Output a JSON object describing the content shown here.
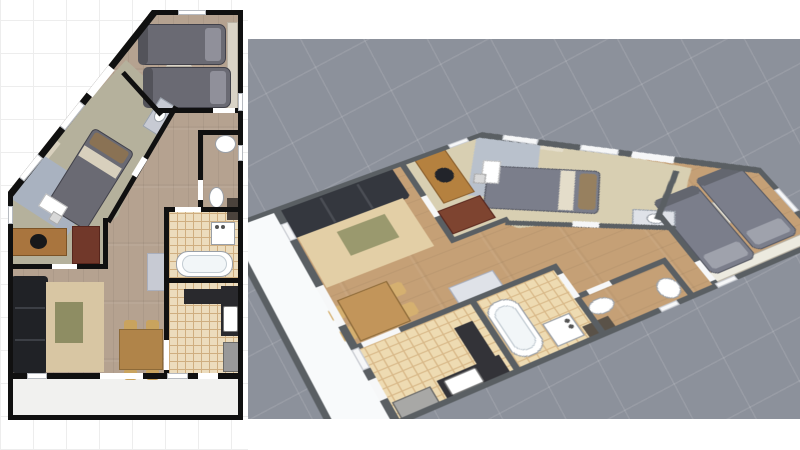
{
  "meta": {
    "description": "Apartment floor plan shown twice: 2D top-down plan (left) and 3D aerial perspective render (right)",
    "left_view": "2D floor plan",
    "right_view": "3D perspective render",
    "visible_text": "none"
  },
  "layout": {
    "width": 800,
    "height": 450,
    "left_canvas": {
      "x": 0,
      "y": 0,
      "w": 248,
      "h": 450,
      "bg": "#ffffff",
      "grid_color": "#ededed",
      "grid_step": 33
    },
    "right_canvas": {
      "x": 248,
      "y": 39,
      "w": 552,
      "h": 380,
      "bg": "#8c919b",
      "grid_color": "rgba(255,255,255,0.10)",
      "grid_step": 56,
      "grid_angle_deg": 62
    },
    "plan2d_offset": {
      "x": 8,
      "y": 10
    },
    "plan3d_position": {
      "x": 158,
      "y": -10
    },
    "plan3d_transform": "perspective(1400px) rotateX(42deg) rotateZ(62deg) scale(1.28)"
  },
  "themes": {
    "plan2d": {
      "wall": "#101010",
      "opening": "#ffffff",
      "wood": "#b5a290",
      "olive": "#b5b19c",
      "tile": "#ecdcbd",
      "tileLine": "#cfae80",
      "balcony": "#f1f1ef",
      "closet": "#d9d3c6",
      "bed": "#6a6a73",
      "bedDark": "#53535a",
      "bedBorder": "#41414a",
      "pillowGray": "#90909a",
      "pillowBrown": "#8a7254",
      "linen": "#d8d0bd",
      "rugBlue": "#a9b2c0",
      "rugBeige": "#d8c6a3",
      "tableOlive": "#8e8d63",
      "sofa": "#202226",
      "sofaLine": "#3c3f45",
      "deskWood": "#a9753e",
      "deskEdge": "#7c5326",
      "cabinetRed": "#71382a",
      "dining": "#b08449",
      "chair": "#c9a35e",
      "counter": "#29292d",
      "appliance": "#99999a",
      "hallCab": "#c7cad3",
      "white": "#ffffff",
      "fixture": "#9aa0a8",
      "tallCab": "#4a423c",
      "chairBlack": "#17181a",
      "winEdge": "#b6bac0"
    },
    "plan3d": {
      "wall": "#5a5f63",
      "opening": "#f6f7f8",
      "wood": "#c5a076",
      "olive": "#d8cfb2",
      "tile": "#eedbb2",
      "tileLine": "#d8b888",
      "balcony": "#f8fafb",
      "closet": "#eceadf",
      "bed": "#7b7e8b",
      "bedDark": "#63666f",
      "bedBorder": "#565964",
      "pillowGray": "#9fa2ac",
      "pillowBrown": "#97805f",
      "linen": "#e4ddca",
      "rugBlue": "#b9c1cc",
      "rugBeige": "#e3cfa6",
      "tableOlive": "#9a996e",
      "sofa": "#34373e",
      "sofaLine": "#4a4d54",
      "deskWood": "#b5813f",
      "deskEdge": "#8a5e2c",
      "cabinetRed": "#7e4430",
      "dining": "#c2955a",
      "chair": "#d5b070",
      "counter": "#333338",
      "appliance": "#a8a8a6",
      "hallCab": "#dfe2e8",
      "white": "#ffffff",
      "fixture": "#9aa0a8",
      "tallCab": "#5a5248",
      "chairBlack": "#22242a",
      "winEdge": "#c9ccd2"
    }
  },
  "plan": {
    "w": 235,
    "h": 410,
    "outline": [
      [
        144,
        0
      ],
      [
        235,
        0
      ],
      [
        235,
        410
      ],
      [
        0,
        410
      ],
      [
        0,
        182
      ]
    ],
    "floors": [
      {
        "n": "floor-wood-base",
        "t": "rect",
        "x": 0,
        "y": 0,
        "w": 235,
        "h": 410,
        "f": "wood",
        "pat": "wood"
      },
      {
        "n": "floor-bedroom-office-olive",
        "t": "poly",
        "x": 0,
        "y": 0,
        "w": 235,
        "h": 410,
        "f": "olive",
        "pts": [
          [
            118,
            50
          ],
          [
            170,
            98
          ],
          [
            122,
            172
          ],
          [
            110,
            206
          ],
          [
            97,
            214
          ],
          [
            97,
            258
          ],
          [
            0,
            258
          ],
          [
            0,
            180
          ]
        ]
      },
      {
        "n": "floor-bathroom-tile",
        "t": "rect",
        "x": 161,
        "y": 202,
        "w": 71,
        "h": 66,
        "f": "tile",
        "pat": "tile"
      },
      {
        "n": "floor-kitchen-tile",
        "t": "rect",
        "x": 161,
        "y": 273,
        "w": 71,
        "h": 95,
        "f": "tile",
        "pat": "tile"
      },
      {
        "n": "floor-balcony",
        "t": "rect",
        "x": 5,
        "y": 369,
        "w": 225,
        "h": 36,
        "f": "balcony"
      }
    ],
    "furniture": [
      {
        "n": "twin-room-wardrobe",
        "t": "rect",
        "x": 219,
        "y": 12,
        "w": 11,
        "h": 88,
        "f": "closet",
        "bd": "#b9b2a4"
      },
      {
        "n": "twin-room-nightstand",
        "t": "rect",
        "x": 158,
        "y": 46,
        "w": 26,
        "h": 11,
        "f": "closet",
        "bd": "#b9b2a4"
      },
      {
        "n": "twin-bed-1",
        "t": "rect",
        "x": 130,
        "y": 14,
        "w": 88,
        "h": 41,
        "f": "bed",
        "bd": "bedBorder",
        "rad": 7
      },
      {
        "n": "twin-bed-1-foot",
        "t": "rect",
        "x": 130,
        "y": 14,
        "w": 10,
        "h": 41,
        "f": "bedDark",
        "rad": 7
      },
      {
        "n": "twin-bed-1-pillow",
        "t": "rect",
        "x": 197,
        "y": 18,
        "w": 16,
        "h": 33,
        "f": "pillowGray",
        "rad": 3
      },
      {
        "n": "twin-bed-2",
        "t": "rect",
        "x": 135,
        "y": 57,
        "w": 88,
        "h": 41,
        "f": "bed",
        "bd": "bedBorder",
        "rad": 7
      },
      {
        "n": "twin-bed-2-foot",
        "t": "rect",
        "x": 135,
        "y": 57,
        "w": 10,
        "h": 41,
        "f": "bedDark",
        "rad": 7
      },
      {
        "n": "twin-bed-2-pillow",
        "t": "rect",
        "x": 202,
        "y": 61,
        "w": 16,
        "h": 33,
        "f": "pillowGray",
        "rad": 3
      },
      {
        "n": "master-closet-strip",
        "t": "line",
        "x1": 14,
        "y1": 172,
        "x2": 48,
        "y2": 130,
        "th": 12,
        "f": "linen"
      },
      {
        "n": "master-rug",
        "t": "rect",
        "x": 8,
        "y": 156,
        "w": 72,
        "h": 54,
        "r": 33,
        "f": "rugBlue"
      },
      {
        "n": "master-bed",
        "t": "rect",
        "x": 58,
        "y": 123,
        "w": 48,
        "h": 92,
        "r": 32,
        "f": "bed",
        "bd": "bedBorder",
        "rad": 5
      },
      {
        "n": "master-bed-pillow",
        "t": "rect",
        "x": 81,
        "y": 131,
        "w": 40,
        "h": 14,
        "r": 32,
        "f": "pillowBrown",
        "rad": 3
      },
      {
        "n": "master-bed-linen",
        "t": "rect",
        "x": 70,
        "y": 146,
        "w": 44,
        "h": 12,
        "r": 32,
        "f": "linen"
      },
      {
        "n": "master-desk",
        "t": "rect",
        "x": 32,
        "y": 189,
        "w": 26,
        "h": 15,
        "r": 32,
        "f": "white",
        "bd": "#bbbbbb"
      },
      {
        "n": "master-desk-chair",
        "t": "rect",
        "x": 42,
        "y": 203,
        "w": 11,
        "h": 10,
        "r": 32,
        "f": "#d8d8d8",
        "bd": "#aaaaaa"
      },
      {
        "n": "master-vanity",
        "t": "rect",
        "x": 135,
        "y": 97,
        "w": 34,
        "h": 20,
        "r": -58,
        "f": "hallCab",
        "bd": "#98a0aa"
      },
      {
        "n": "master-vanity-sink",
        "t": "ell",
        "x": 145,
        "y": 100,
        "w": 14,
        "h": 11,
        "r": -58,
        "f": "white",
        "bd": "fixture"
      },
      {
        "n": "office-desk",
        "t": "rect",
        "x": 4,
        "y": 218,
        "w": 55,
        "h": 28,
        "f": "deskWood",
        "bd": "deskEdge"
      },
      {
        "n": "office-chair",
        "t": "ell",
        "x": 22,
        "y": 224,
        "w": 17,
        "h": 15,
        "f": "chairBlack"
      },
      {
        "n": "office-cabinet",
        "t": "rect",
        "x": 64,
        "y": 216,
        "w": 28,
        "h": 38,
        "f": "cabinetRed",
        "bd": "#57251c"
      },
      {
        "n": "sofa",
        "t": "rect",
        "x": 3,
        "y": 266,
        "w": 37,
        "h": 97,
        "f": "sofa",
        "rad": 4
      },
      {
        "n": "sofa-seam-1",
        "t": "rect",
        "x": 7,
        "y": 297,
        "w": 30,
        "h": 2,
        "f": "sofaLine"
      },
      {
        "n": "sofa-seam-2",
        "t": "rect",
        "x": 7,
        "y": 329,
        "w": 30,
        "h": 2,
        "f": "sofaLine"
      },
      {
        "n": "living-rug",
        "t": "rect",
        "x": 38,
        "y": 272,
        "w": 58,
        "h": 90,
        "f": "rugBeige"
      },
      {
        "n": "coffee-table",
        "t": "rect",
        "x": 47,
        "y": 292,
        "w": 28,
        "h": 41,
        "f": "tableOlive"
      },
      {
        "n": "dining-chair-1",
        "t": "rect",
        "x": 116,
        "y": 310,
        "w": 13,
        "h": 11,
        "f": "chair",
        "rad": 3
      },
      {
        "n": "dining-chair-2",
        "t": "rect",
        "x": 138,
        "y": 310,
        "w": 13,
        "h": 11,
        "f": "chair",
        "rad": 3
      },
      {
        "n": "dining-chair-3",
        "t": "rect",
        "x": 116,
        "y": 359,
        "w": 13,
        "h": 11,
        "f": "chair",
        "rad": 3
      },
      {
        "n": "dining-chair-4",
        "t": "rect",
        "x": 138,
        "y": 359,
        "w": 13,
        "h": 11,
        "f": "chair",
        "rad": 3
      },
      {
        "n": "dining-table",
        "t": "rect",
        "x": 111,
        "y": 319,
        "w": 44,
        "h": 41,
        "f": "dining",
        "bd": "#8d6a38"
      },
      {
        "n": "hall-cabinet",
        "t": "rect",
        "x": 139,
        "y": 243,
        "w": 18,
        "h": 38,
        "f": "hallCab",
        "bd": "#a9aebc"
      },
      {
        "n": "tall-cabinet",
        "t": "rect",
        "x": 219,
        "y": 188,
        "w": 12,
        "h": 22,
        "f": "tallCab"
      },
      {
        "n": "bathtub",
        "t": "rect",
        "x": 168,
        "y": 241,
        "w": 57,
        "h": 26,
        "f": "white",
        "bd": "fixture",
        "rad": 12
      },
      {
        "n": "bathtub-inner",
        "t": "rect",
        "x": 174,
        "y": 245,
        "w": 45,
        "h": 18,
        "f": "#f2f6f8",
        "bd": "#c3ccd3",
        "rad": 9
      },
      {
        "n": "washing-machine",
        "t": "rect",
        "x": 203,
        "y": 212,
        "w": 24,
        "h": 23,
        "f": "white",
        "bd": "fixture"
      },
      {
        "n": "washer-knob-1",
        "t": "ell",
        "x": 207,
        "y": 215,
        "w": 4,
        "h": 4,
        "f": "#555555"
      },
      {
        "n": "washer-knob-2",
        "t": "ell",
        "x": 213,
        "y": 215,
        "w": 4,
        "h": 4,
        "f": "#555555"
      },
      {
        "n": "wc-corner-sink",
        "t": "ell",
        "x": 207,
        "y": 125,
        "w": 21,
        "h": 18,
        "f": "white",
        "bd": "fixture"
      },
      {
        "n": "wc-toilet",
        "t": "ell",
        "x": 201,
        "y": 177,
        "w": 15,
        "h": 21,
        "f": "white",
        "bd": "fixture"
      },
      {
        "n": "kitchen-counter-top",
        "t": "rect",
        "x": 176,
        "y": 279,
        "w": 38,
        "h": 15,
        "f": "counter"
      },
      {
        "n": "kitchen-counter-right",
        "t": "rect",
        "x": 213,
        "y": 276,
        "w": 19,
        "h": 50,
        "f": "counter"
      },
      {
        "n": "kitchen-sink",
        "t": "rect",
        "x": 215,
        "y": 296,
        "w": 15,
        "h": 26,
        "f": "white",
        "bd": "#777777",
        "rad": 2
      },
      {
        "n": "kitchen-appliance",
        "t": "rect",
        "x": 215,
        "y": 332,
        "w": 17,
        "h": 30,
        "f": "appliance",
        "bd": "#6a6a68"
      }
    ],
    "walls": [
      {
        "n": "wall-top",
        "t": "rect",
        "x": 140,
        "y": 0,
        "w": 95,
        "h": 5
      },
      {
        "n": "wall-right",
        "t": "rect",
        "x": 230,
        "y": 0,
        "w": 5,
        "h": 410
      },
      {
        "n": "wall-bottom",
        "t": "rect",
        "x": 0,
        "y": 405,
        "w": 235,
        "h": 5
      },
      {
        "n": "wall-left",
        "t": "rect",
        "x": 0,
        "y": 178,
        "w": 5,
        "h": 232
      },
      {
        "n": "wall-diagonal",
        "t": "line",
        "x1": 2,
        "y1": 184,
        "x2": 146,
        "y2": 2,
        "th": 8
      },
      {
        "n": "wall-twin-left-diag",
        "t": "line",
        "x1": 115,
        "y1": 62,
        "x2": 153,
        "y2": 104,
        "th": 5
      },
      {
        "n": "wall-twin-bottom",
        "t": "rect",
        "x": 150,
        "y": 98,
        "w": 80,
        "h": 5
      },
      {
        "n": "wall-master-hall-diag",
        "t": "line",
        "x1": 168,
        "y1": 96,
        "x2": 100,
        "y2": 212,
        "th": 5
      },
      {
        "n": "wall-office-right",
        "t": "rect",
        "x": 95,
        "y": 208,
        "w": 5,
        "h": 51
      },
      {
        "n": "wall-office-bottom",
        "t": "rect",
        "x": 0,
        "y": 254,
        "w": 100,
        "h": 5
      },
      {
        "n": "wall-kitchen-left",
        "t": "rect",
        "x": 156,
        "y": 200,
        "w": 5,
        "h": 168
      },
      {
        "n": "wall-bath-kitchen",
        "t": "rect",
        "x": 156,
        "y": 268,
        "w": 76,
        "h": 5
      },
      {
        "n": "wall-bath-top",
        "t": "rect",
        "x": 156,
        "y": 197,
        "w": 76,
        "h": 5
      },
      {
        "n": "wall-balcony",
        "t": "rect",
        "x": 0,
        "y": 363,
        "w": 235,
        "h": 6
      },
      {
        "n": "wall-wc-top",
        "t": "rect",
        "x": 193,
        "y": 120,
        "w": 40,
        "h": 5
      },
      {
        "n": "wall-wc-left",
        "t": "rect",
        "x": 190,
        "y": 120,
        "w": 5,
        "h": 50
      },
      {
        "n": "wall-wc-left-stub",
        "t": "rect",
        "x": 190,
        "y": 190,
        "w": 5,
        "h": 10
      }
    ],
    "openings": [
      {
        "n": "door-twin-bedroom",
        "t": "rect",
        "x": 205,
        "y": 98,
        "w": 22,
        "h": 5
      },
      {
        "n": "door-entry",
        "t": "line",
        "x1": 81,
        "y1": 84,
        "x2": 103,
        "y2": 57,
        "th": 9
      },
      {
        "n": "window-diagonal-1",
        "t": "line",
        "x1": 13,
        "y1": 169,
        "x2": 32,
        "y2": 146,
        "th": 8,
        "bd": "winEdge"
      },
      {
        "n": "window-diagonal-2",
        "t": "line",
        "x1": 54,
        "y1": 118,
        "x2": 74,
        "y2": 93,
        "th": 8,
        "bd": "winEdge"
      },
      {
        "n": "window-top",
        "t": "rect",
        "x": 170,
        "y": 0,
        "w": 28,
        "h": 5,
        "bd": "winEdge"
      },
      {
        "n": "window-right-1",
        "t": "rect",
        "x": 230,
        "y": 83,
        "w": 5,
        "h": 18,
        "bd": "winEdge"
      },
      {
        "n": "window-right-2",
        "t": "rect",
        "x": 230,
        "y": 135,
        "w": 5,
        "h": 16,
        "bd": "winEdge"
      },
      {
        "n": "window-left",
        "t": "rect",
        "x": 0,
        "y": 196,
        "w": 5,
        "h": 18,
        "bd": "winEdge"
      },
      {
        "n": "door-master-bedroom",
        "t": "line",
        "x1": 137,
        "y1": 148,
        "x2": 126,
        "y2": 166,
        "th": 6
      },
      {
        "n": "door-office",
        "t": "rect",
        "x": 44,
        "y": 254,
        "w": 25,
        "h": 5
      },
      {
        "n": "door-bathroom",
        "t": "rect",
        "x": 167,
        "y": 197,
        "w": 26,
        "h": 5
      },
      {
        "n": "door-kitchen",
        "t": "rect",
        "x": 156,
        "y": 330,
        "w": 5,
        "h": 30
      },
      {
        "n": "door-wc",
        "t": "rect",
        "x": 190,
        "y": 170,
        "w": 5,
        "h": 20
      },
      {
        "n": "balcony-door-1",
        "t": "rect",
        "x": 92,
        "y": 363,
        "w": 43,
        "h": 6
      },
      {
        "n": "balcony-door-2",
        "t": "rect",
        "x": 190,
        "y": 363,
        "w": 20,
        "h": 6
      },
      {
        "n": "balcony-window-1",
        "t": "rect",
        "x": 19,
        "y": 363,
        "w": 20,
        "h": 6,
        "bd": "winEdge"
      },
      {
        "n": "balcony-window-2",
        "t": "rect",
        "x": 159,
        "y": 363,
        "w": 21,
        "h": 6,
        "bd": "winEdge"
      }
    ]
  }
}
